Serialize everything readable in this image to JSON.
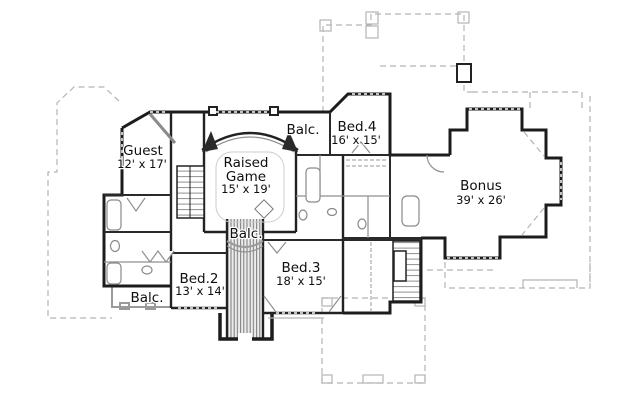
{
  "document": {
    "type": "second-floor-plan-drawing",
    "background": "#ffffff"
  },
  "rooms": {
    "guest": {
      "name": "Guest",
      "dims": "12' x 17'"
    },
    "balc_top": {
      "name": "Balc."
    },
    "bed4": {
      "name": "Bed.4",
      "dims": "16' x 15'"
    },
    "raised_game": {
      "name_line1": "Raised",
      "name_line2": "Game",
      "dims": "15' x 19'"
    },
    "bonus": {
      "name": "Bonus",
      "dims": "39' x 26'"
    },
    "balc_center": {
      "name": "Balc."
    },
    "bed2": {
      "name": "Bed.2",
      "dims": "13' x 14'"
    },
    "balc_lower": {
      "name": "Balc."
    },
    "bed3": {
      "name": "Bed.3",
      "dims": "18' x 15'"
    }
  },
  "colors": {
    "wall": "#1c1c1c",
    "light_line": "#8f8f8f",
    "roof_dash": "#b5b5b5",
    "text": "#0e0e0e",
    "background": "#ffffff"
  }
}
